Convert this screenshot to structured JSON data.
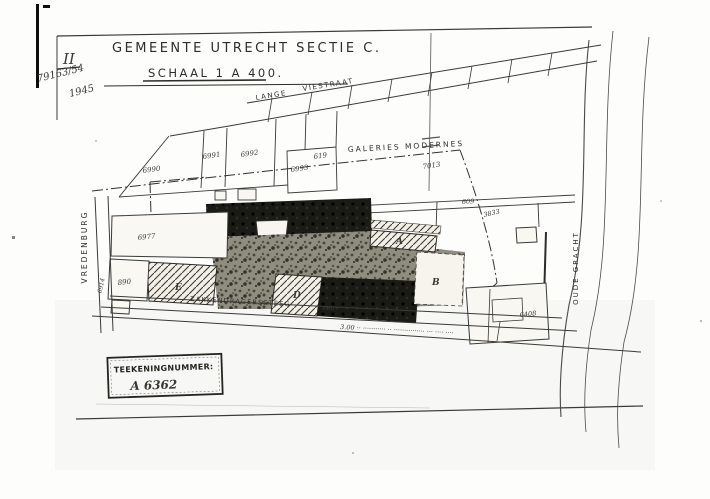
{
  "meta": {
    "sheet_class": "II",
    "file_number": "79163/54",
    "year": "1945"
  },
  "title": {
    "line1": "GEMEENTE UTRECHT SECTIE C.",
    "line2": "SCHAAL 1 A 400."
  },
  "streets": {
    "lange": "LANGE",
    "viestraat": "VIESTRAAT",
    "galeries_modernes": "GALERIES MODERNES",
    "vredenburg": "VREDENBURG",
    "oude_gracht": "OUDE GRACHT",
    "zakkendragerssteeg": "ZAKKENDRAGERSSTEEG"
  },
  "parcels": {
    "p6990": "6990",
    "p6991": "6991",
    "p6992": "6992",
    "p6993": "6993",
    "p619": "619",
    "p7013": "7013",
    "p609": "609",
    "p3833": "3833",
    "p6977": "6977",
    "p890": "890",
    "p6914": "6914",
    "p6408": "6408"
  },
  "buildings": {
    "a": "A",
    "b": "B",
    "d": "D",
    "e": "E"
  },
  "measurements": {
    "m480": "4.80"
  },
  "street_note": "3.00 ·· ··········· ·· ··············· ··· ···· ····",
  "stamp": {
    "label": "TEEKENINGNUMMER:",
    "number": "A 6362"
  },
  "colors": {
    "ink": "#2e2d28",
    "dark_building": "#1b1b16",
    "paper": "#fdfdfc"
  }
}
